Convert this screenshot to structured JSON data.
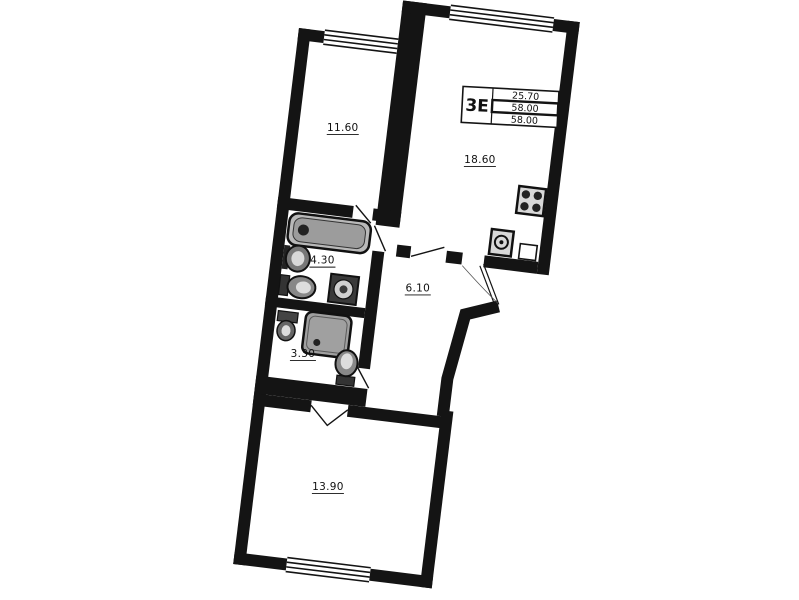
{
  "plan": {
    "unit_type_label": "3Е",
    "title_block": {
      "rows": [
        "25.70",
        "58.00",
        "58.00"
      ]
    },
    "rooms": [
      {
        "name": "room-upper-left",
        "area": "11.60"
      },
      {
        "name": "kitchen-living-room",
        "area": "18.60"
      },
      {
        "name": "bathroom",
        "area": "4.30"
      },
      {
        "name": "hallway",
        "area": "6.10"
      },
      {
        "name": "shower-wc-room",
        "area": "3.30"
      },
      {
        "name": "room-lower",
        "area": "13.90"
      }
    ],
    "fixtures": [
      "bathtub",
      "wash-basin",
      "toilet",
      "washing-machine",
      "corner-basin",
      "shower-cabin",
      "toilet",
      "stove",
      "kitchen-sink"
    ],
    "colors": {
      "walls": "#141414",
      "fixture_gray": "#9c9c9c",
      "paper": "#ffffff"
    }
  }
}
